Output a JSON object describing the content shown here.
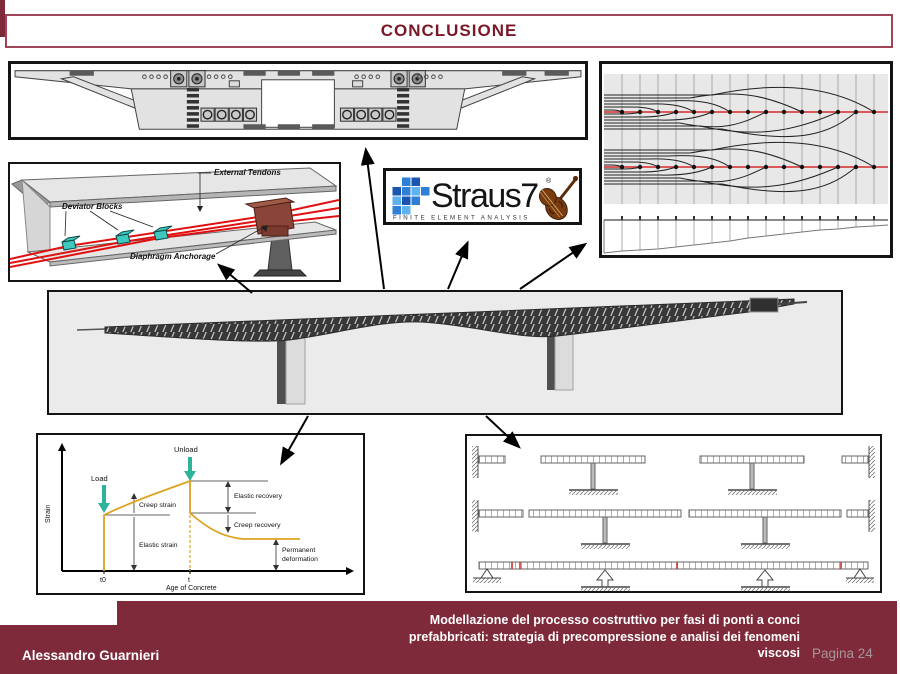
{
  "title": "CONCLUSIONE",
  "footer": {
    "author": "Alessandro Guarnieri",
    "caption": [
      "Modellazione del processo costruttivo per fasi di ponti a conci",
      "prefabbricati: strategia di precompressione e analisi dei fenomeni",
      "viscosi"
    ],
    "page_label": "Pagina 24"
  },
  "colors": {
    "maroon": "#7E2A3A",
    "title_text": "#7A1828",
    "tendon_red": "#E01010",
    "deviator_teal": "#3FC8C0",
    "curve_orange": "#DDA321",
    "straus_blue_dark": "#1A55B0",
    "straus_blue_mid": "#2E7FD6",
    "straus_blue_light": "#5FB2F2"
  },
  "straus7_logo": {
    "brand": "Straus7",
    "registered": "®",
    "tagline": "FINITE ELEMENT ANALYSIS"
  },
  "tendon_3d_labels": {
    "external_tendons": "External Tendons",
    "deviator_blocks": "Deviator Blocks",
    "diaphragm_anchorage": "Diaphragm Anchorage"
  },
  "strain_chart": {
    "type": "line",
    "ylabel": "Strain",
    "xlabel": "Age of Concrete",
    "xticks": [
      "t0",
      "t"
    ],
    "annotations": {
      "load": "Load",
      "unload": "Unload",
      "creep_strain": "Creep strain",
      "elastic_strain": "Elastic strain",
      "elastic_recovery": "Elastic recovery",
      "creep_recovery": "Creep recovery",
      "permanent_line1": "Permanent",
      "permanent_line2": "deformation"
    }
  }
}
